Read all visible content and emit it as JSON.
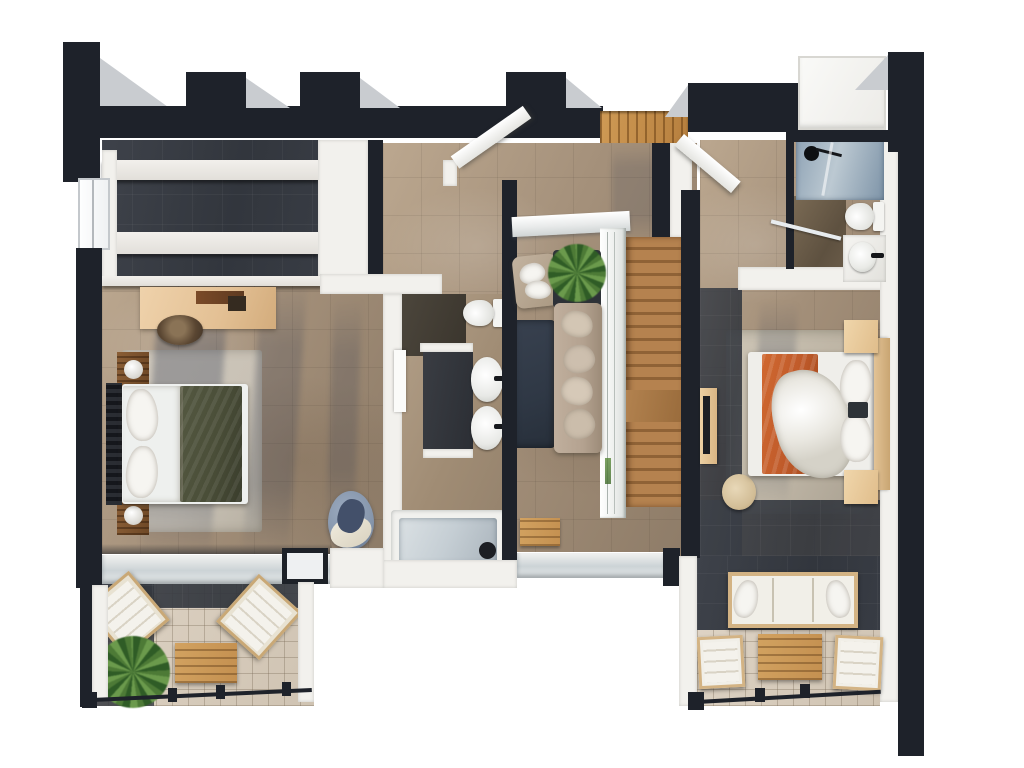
{
  "scene": {
    "type": "3d-architectural-floor-plan-render",
    "view": "top-down isometric",
    "level": "upper floor",
    "background": "white"
  },
  "palette": {
    "wall-dark": "#1e222a",
    "wall-white": "#f2f1ed",
    "shadow-grey": "#c9ccd0",
    "floor-stone": "#a4907a",
    "floor-stone-light": "#bba78f",
    "floor-stone-dark": "#8d7b67",
    "slate-dark": "#32363d",
    "balcony-tile": "#cfc3b2",
    "wood-stair-light": "#b5824f",
    "wood-stair-dark": "#8f6236",
    "wood-light": "#e4c496",
    "rug-dark": "#2f3845",
    "rug-light": "#c9c2b6",
    "sofa-taupe": "#b4a290",
    "green-blanket": "#4a4e38",
    "orange-blanket": "#bf5a2a",
    "chair-blue": "#8595ab",
    "plant-green": "#4d7a36",
    "plant-light": "#6b9a4c",
    "plant-dark": "#2f5c26",
    "glass-blue": "#8fa3b5",
    "water": "#c5ced4"
  },
  "rooms": [
    {
      "name": "master-bedroom",
      "position": "left",
      "furniture": [
        "double-bed-dark-headboard",
        "green-throw-blanket",
        "two-dark-wood-nightstands",
        "round-table-lamps",
        "area-rug",
        "desk",
        "desk-chair",
        "blue-armchair",
        "walk-in-wardrobe-shelves",
        "window",
        "glass-wall-to-balcony"
      ]
    },
    {
      "name": "ensuite-bathroom",
      "position": "center-left",
      "furniture": [
        "toilet",
        "double-sink-vanity",
        "bathtub",
        "pocket-door"
      ]
    },
    {
      "name": "hallway-landing",
      "position": "center",
      "furniture": [
        "sofa",
        "accent-armchair",
        "potted-plant",
        "dark-rug",
        "glass-stair-railing",
        "open-door-left",
        "open-door-right",
        "wood-slat-skylight"
      ]
    },
    {
      "name": "staircase",
      "position": "center-right",
      "furniture": [
        "wooden-treads",
        "mid-landing",
        "glass-balustrade"
      ]
    },
    {
      "name": "second-bedroom",
      "position": "right",
      "furniture": [
        "double-bed-wood-headboard",
        "orange-throw-blanket",
        "two-light-wood-nightstands",
        "area-rug",
        "tv-console",
        "tv",
        "curved-stool"
      ]
    },
    {
      "name": "shower-bathroom",
      "position": "top-right",
      "furniture": [
        "glass-shower",
        "shower-head",
        "toilet",
        "round-basin-vanity",
        "black-faucet"
      ]
    },
    {
      "name": "balcony-left",
      "position": "bottom-left",
      "furniture": [
        "two-sun-loungers",
        "slatted-wood-table",
        "potted-palm",
        "metal-railing"
      ]
    },
    {
      "name": "balcony-right",
      "position": "bottom-right",
      "furniture": [
        "outdoor-sofa",
        "two-outdoor-armchairs",
        "slatted-coffee-table",
        "metal-railing"
      ]
    }
  ],
  "structure": {
    "outer_walls": "black with crenellated top edge",
    "inner_wall_caps": "white",
    "stair_direction": "vertical run on right side of landing"
  }
}
